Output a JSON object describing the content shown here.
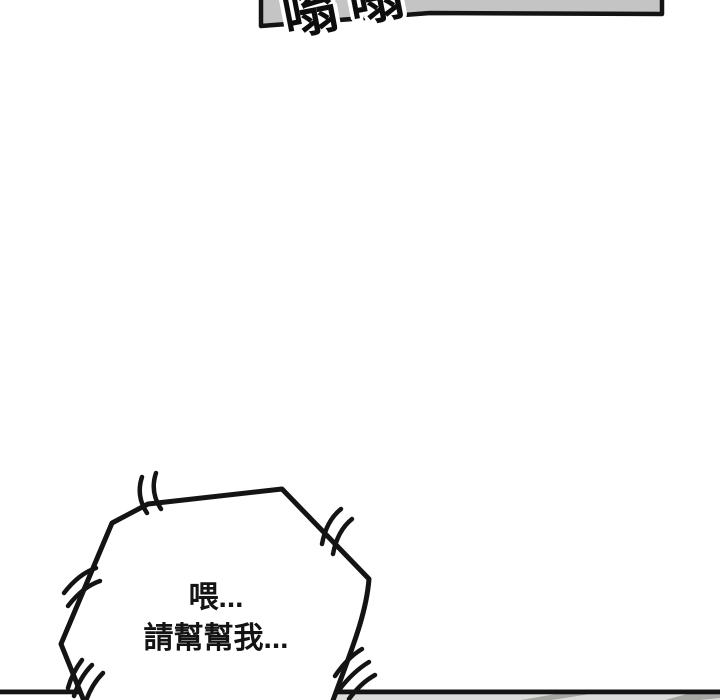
{
  "page": {
    "background_color": "#ffffff",
    "ink_color": "#141414"
  },
  "top_panel": {
    "fill_color": "#c4c4c4",
    "sfx_text": "嗡嗡"
  },
  "speech_bubble": {
    "fill_color": "#ffffff",
    "line1": "喂...",
    "line2": "請幫幫我..."
  },
  "bottom_panel": {
    "strip_color": "#dcdcda",
    "band_color": "#a5a5a2"
  }
}
